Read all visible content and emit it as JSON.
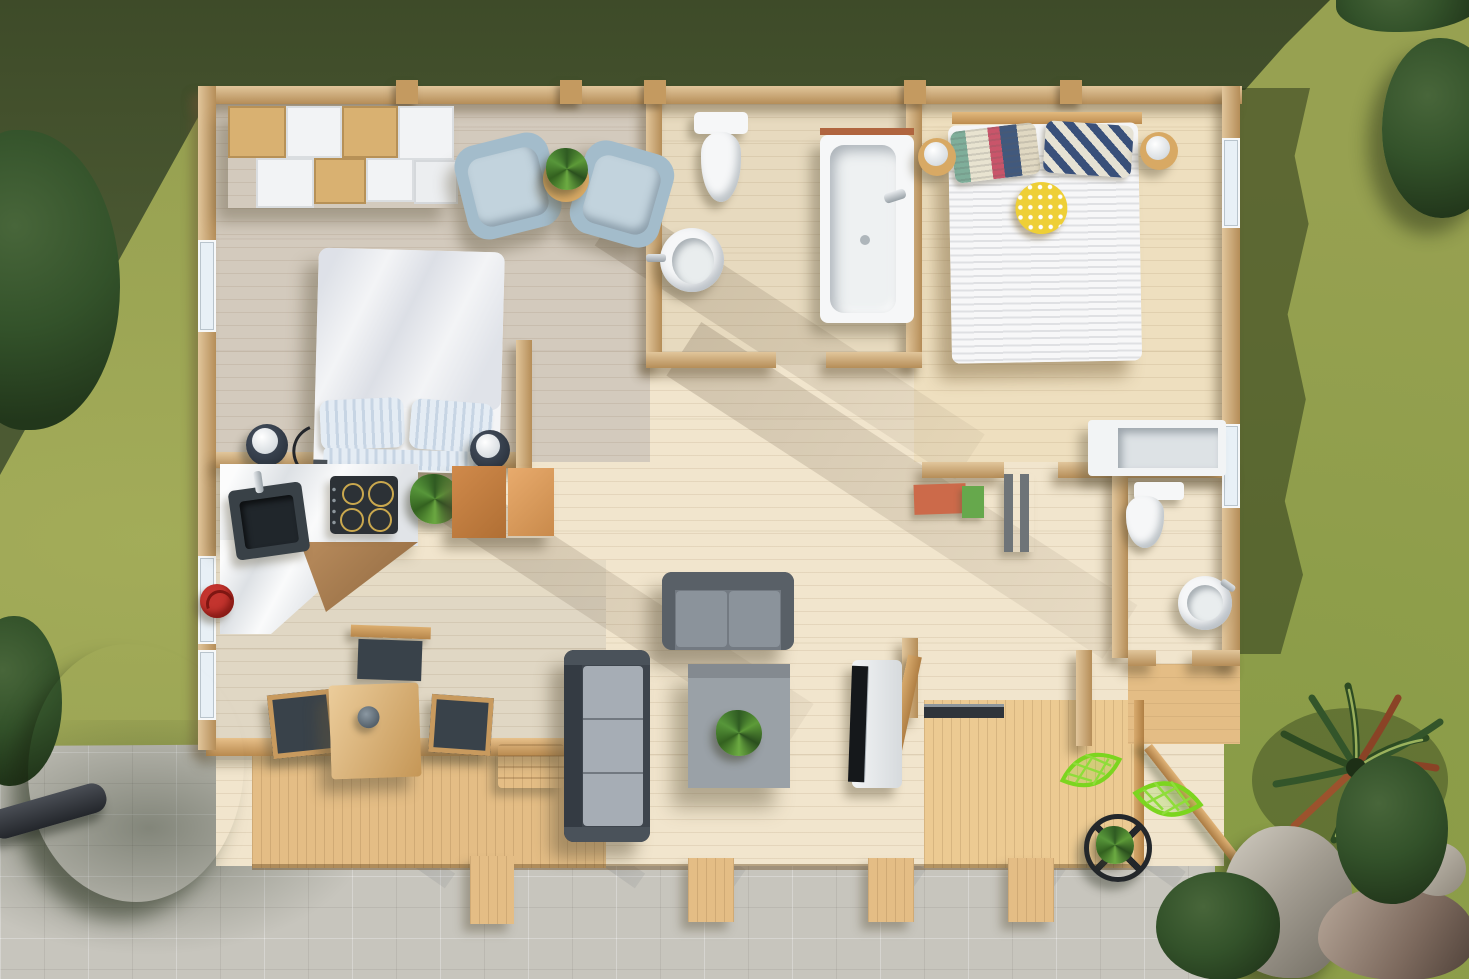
{
  "scene": {
    "description": "Photorealistic top-down 3D render of a single-storey wooden cabin floor plan with surrounding lawn, stone patio and decking",
    "view": "aerial top-down",
    "lighting": "bright daylight, long shadows toward lower-left"
  },
  "palette": {
    "grass_sun": "#97a151",
    "grass_dark": "#4c5a33",
    "pavement": "#c7c5bd",
    "wall_wood": "#c99f66",
    "deck_wood": "#e4bd85",
    "deck_bright": "#ecca92",
    "floor_hall": "#f1e5cd",
    "floor_bed1": "#e0d6c6",
    "floor_bed2": "#eedfbf",
    "floor_bath1": "#e7dabf",
    "floor_veranda": "#ece1cb",
    "white_fixture": "#f6f7f8",
    "marble": "#eef0f2",
    "sofa_gray": "#737a82",
    "sofa_dark": "#3e454d",
    "sofa_cushion": "#a6adb5",
    "table_gray": "#9aa1a7",
    "armchair_blue": "#a3bccb",
    "leaf_green": "#7cd51f",
    "plant_green": "#3f7d2c",
    "cabinet_brown": "#cd8a4e",
    "kettle_red": "#c3342e",
    "mat_red": "#cc6a4a",
    "mat_green": "#66a84c",
    "cushion_yellow": "#eecf36",
    "cooktop_black": "#2c3136",
    "sink_slate": "#394147",
    "rock_gray": "#a8a49c",
    "tv_black": "#15181b",
    "wood_table": "#d8a964"
  },
  "environment": {
    "ground": [
      "sunlit-lawn",
      "shaded-lawn",
      "stone-patio"
    ],
    "vegetation": [
      "corner-bush-top-left",
      "round-bush-right",
      "tree-bottom-left",
      "palm-yucca-bottom-right",
      "bushes-bottom-right"
    ],
    "props": [
      "boulders",
      "fallen-log"
    ]
  },
  "house": {
    "style": "log cabin, top-down with roof removed",
    "rooms": [
      {
        "name": "bedroom-1",
        "position": "top-left",
        "furniture": [
          "cube-wardrobe",
          "armchair",
          "armchair",
          "round-side-table-with-plant",
          "double-bed-white-duvet",
          "bedside-stool-with-lamp",
          "bedside-stool-with-lamp"
        ]
      },
      {
        "name": "bathroom-1",
        "position": "top-middle",
        "furniture": [
          "toilet",
          "round-washbasin",
          "bathtub"
        ]
      },
      {
        "name": "bedroom-2",
        "position": "top-right",
        "furniture": [
          "double-bed-striped-duvet",
          "patterned-pillows",
          "yellow-polkadot-cushion",
          "bedside-table-with-lamp",
          "bedside-table-with-lamp",
          "headboard"
        ]
      },
      {
        "name": "kitchen",
        "position": "middle-left",
        "furniture": [
          "l-shaped-marble-counter",
          "corner-sink",
          "four-ring-cooktop",
          "potted-plant",
          "brown-cabinet",
          "red-kettle"
        ]
      },
      {
        "name": "dining-veranda",
        "position": "bottom-left",
        "furniture": [
          "wooden-dining-table",
          "bowl",
          "dining-chair",
          "dining-chair",
          "dining-chair",
          "bench",
          "railing"
        ]
      },
      {
        "name": "living-area",
        "position": "center",
        "furniture": [
          "two-seat-sofa",
          "three-seat-sofa",
          "square-coffee-table-with-plant",
          "tv-on-stand",
          "open-entry-door"
        ]
      },
      {
        "name": "bathroom-2",
        "position": "middle-right",
        "furniture": [
          "white-cabinet",
          "toilet",
          "round-washbasin"
        ]
      },
      {
        "name": "hallway",
        "position": "center-right",
        "furniture": [
          "red-mat",
          "green-mat",
          "gray-shelf"
        ]
      }
    ],
    "outdoor": {
      "deck": [
        "veranda-skirt",
        "main-deck",
        "side-deck",
        "step-ramps",
        "handrail"
      ],
      "furniture": [
        "leaf-chair",
        "leaf-chair",
        "round-wire-table-with-plant"
      ]
    }
  }
}
